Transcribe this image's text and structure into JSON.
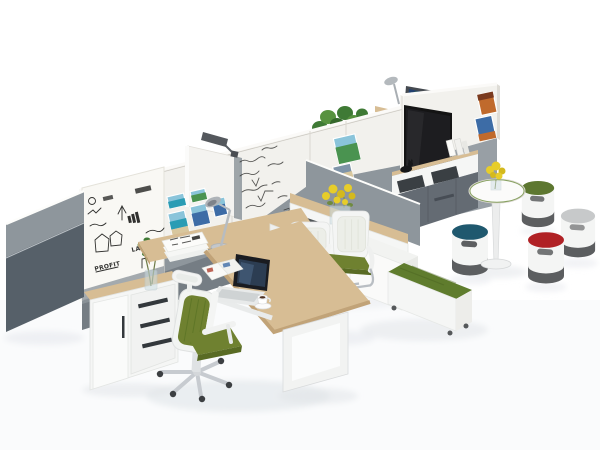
{
  "scene": {
    "description": "3D render of a modular open-plan office: whiteboard partitions, L-shaped desk with laptop, ergonomic chair, visitor chairs, TV media wall, bench storage, cafe table and colorful cylinder stools",
    "whiteboard_words": {
      "profit": "PROFIT",
      "law": "LAW"
    },
    "objects": [
      "fabric-end-panel",
      "sketch-whiteboard",
      "photo-panel",
      "formula-whiteboard",
      "partition-task-lamp",
      "storage-cabinet",
      "plant-vase",
      "return-desk",
      "chrome-desk-lamp",
      "magazine-stack",
      "main-desk",
      "laptop",
      "open-magazine",
      "coffee-cup",
      "ergonomic-chair",
      "visitor-chair",
      "visitor-chair",
      "credenza-with-flowers",
      "spine-panel",
      "storage-cube",
      "green-bench",
      "tv-wall",
      "television",
      "media-shelf",
      "media-cabinet",
      "dog-figurine",
      "bookends",
      "wall-photos",
      "monitor-behind-wall",
      "lamp-behind-wall",
      "planter-greenery",
      "cafe-table",
      "table-flowers",
      "stool-green",
      "stool-gray",
      "stool-blue",
      "stool-red"
    ]
  },
  "palette": {
    "bg": "#ffffff",
    "shadow": "#dfe3e8",
    "wall_white": "#f2f1ed",
    "wall_cap": "#fbfaf8",
    "wall_seam": "#dbd8d1",
    "panel_gray": "#8e969c",
    "panel_dark": "#566069",
    "whiteboard": "#f9f8f4",
    "wood": "#d7bd94",
    "wood_dark": "#c1a378",
    "white_furn": "#f5f6f5",
    "white_shade": "#e7e8e6",
    "handle": "#33383c",
    "ink": "#30302e",
    "green_seat": "#6f8130",
    "green_dark": "#596b24",
    "bench_green": "#5f7c2d",
    "chrome": "#b9bec3",
    "tv": "#141414",
    "screen_navy": "#22406e",
    "photo_teal": "#2a9cb4",
    "photo_sky": "#8ac4da",
    "photo_sand": "#d8c79e",
    "photo_green": "#4a9350",
    "photo_orange": "#c06a2c",
    "photo_blue": "#3d6ca6",
    "plant": "#3f7a35",
    "plant_light": "#57923f",
    "flower": "#e7cd2a",
    "glass": "#ccdde2",
    "stool_body": "#f4f5f4",
    "stool_base": "#5c5e60",
    "stool_blue": "#1f586e",
    "stool_red": "#b02125",
    "stool_green": "#5d7730",
    "stool_gray": "#c7c9ca"
  }
}
